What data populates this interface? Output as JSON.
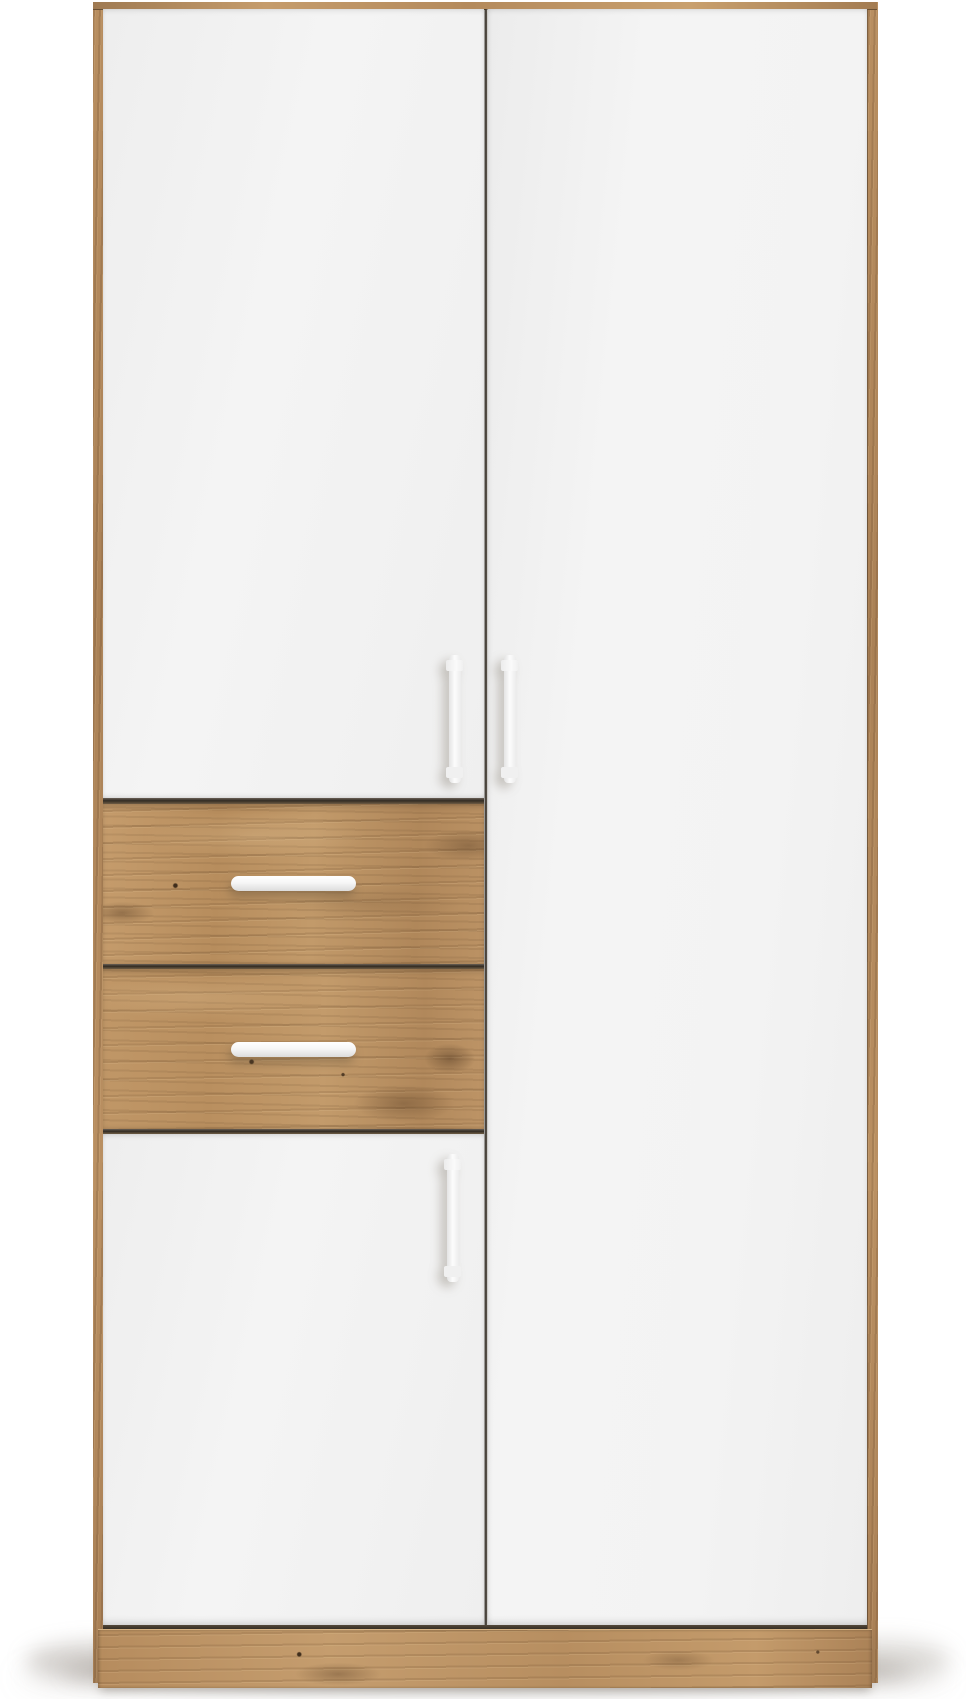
{
  "scene": {
    "description": "Product photograph of a tall two-door wardrobe on a plain white background. Oak-effect frame, top edge and plinth; full-height white right door; left side has a white upper door, two oak-effect drawers with white horizontal bar handles, and a white lower door. Three vertical white bar handles on the doors. Soft shadow on the floor.",
    "background_color": "#ffffff",
    "colors": {
      "background": "#ffffff",
      "oak": "#b98f61",
      "oak_light": "#d0ab7c",
      "oak_dark": "#8a6747",
      "door_white": "#f3f3f3",
      "door_shade": "#e6e6e6",
      "seam": "#3a332b",
      "handle_white": "#fbfbfb",
      "handle_shade": "#dcdcdc",
      "floor_shadow": "rgba(120,112,102,0.42)"
    },
    "parts": {
      "doors": [
        "upper-left-door",
        "lower-left-door",
        "right-door"
      ],
      "drawers": [
        "drawer-1",
        "drawer-2"
      ],
      "handles": {
        "vertical_bar_count": 3,
        "horizontal_bar_count": 2,
        "color_name": "white"
      },
      "frame": "oak side panels, oak top edge, oak plinth"
    }
  }
}
